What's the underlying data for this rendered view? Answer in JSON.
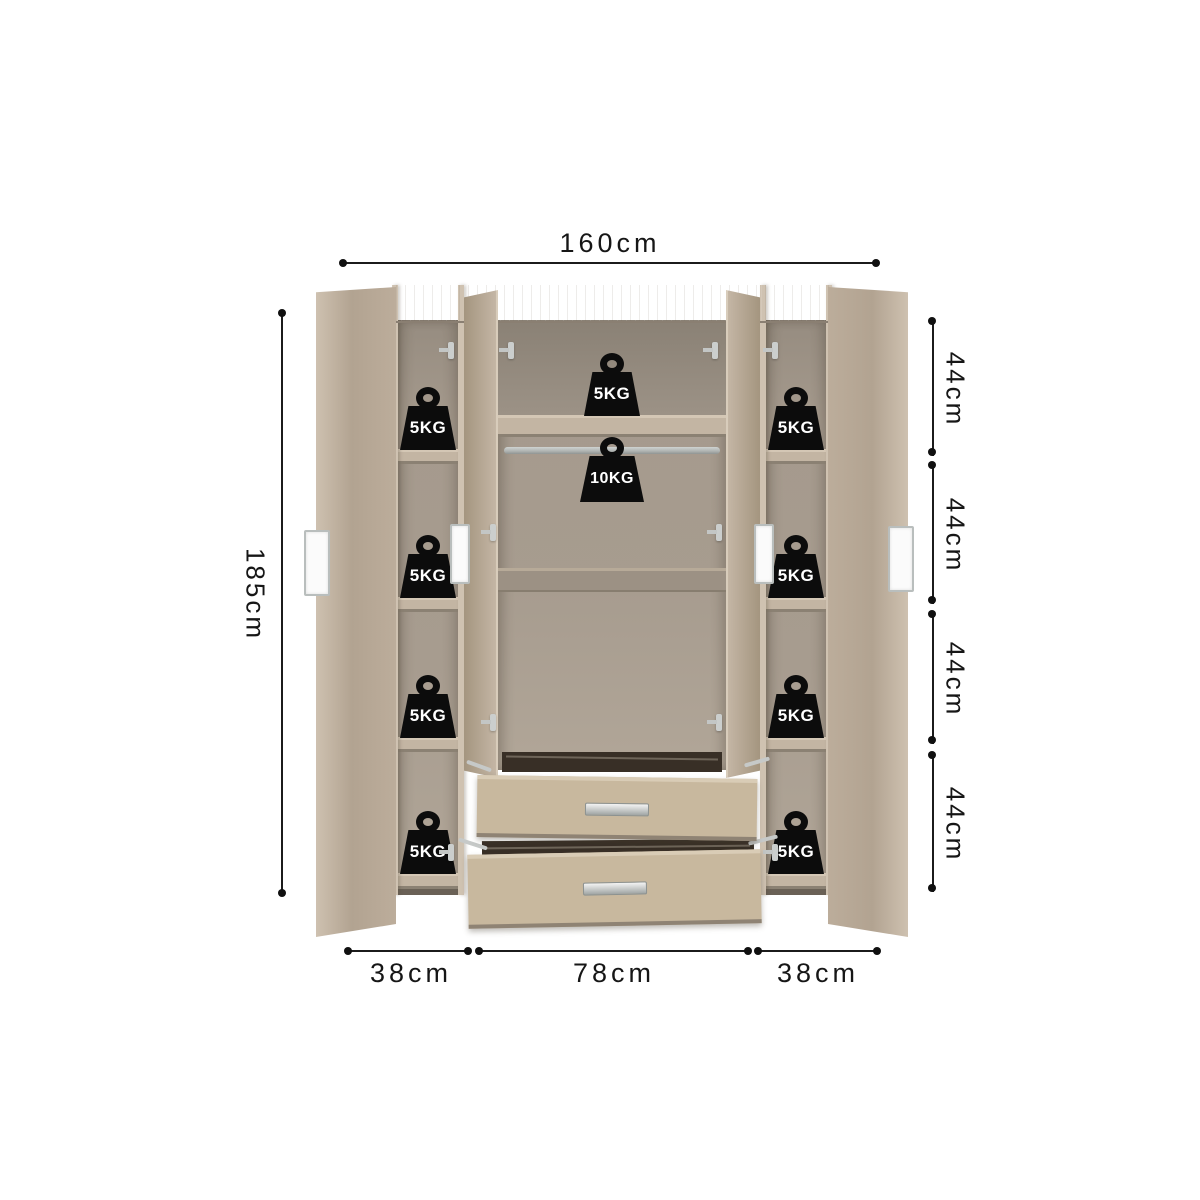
{
  "dimensions": {
    "width_total": "160cm",
    "height_total": "185cm",
    "right_segments": [
      "44cm",
      "44cm",
      "44cm",
      "44cm"
    ],
    "bottom_segments": [
      "38cm",
      "78cm",
      "38cm"
    ]
  },
  "weights": {
    "left_column": [
      "5KG",
      "5KG",
      "5KG",
      "5KG"
    ],
    "right_column": [
      "5KG",
      "5KG",
      "5KG",
      "5KG"
    ],
    "top_shelf": "5KG",
    "hanging_rail": "10KG"
  },
  "colors": {
    "background": "#ffffff",
    "dimension_line": "#1b1b1b",
    "wood_face": "#b3a492",
    "wood_light": "#cec1b0",
    "interior": "#a79c8f",
    "shelf_front": "#c3b5a3",
    "drawer_front": "#c8b89e",
    "badge": "#0c0c0c",
    "badge_text": "#ffffff",
    "metal": "#c6c9c8"
  }
}
